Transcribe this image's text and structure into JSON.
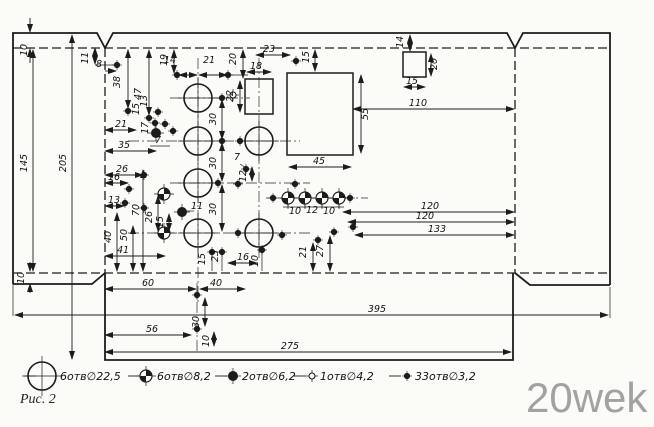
{
  "meta": {
    "caption": "Рис. 2",
    "watermark": "20wek",
    "ink": "#1c1c1c",
    "paper": "#fbfbf8"
  },
  "legend": [
    {
      "type": "d225",
      "symbol": "large-circle-crosshair",
      "sx": 42,
      "lx": 60,
      "label": "6отв∅22,5"
    },
    {
      "type": "d82",
      "symbol": "target-circle",
      "sx": 146,
      "lx": 157,
      "label": "6отв∅8,2"
    },
    {
      "type": "d62",
      "symbol": "filled-circle",
      "sx": 233,
      "lx": 242,
      "label": "2отв∅6,2"
    },
    {
      "type": "d42",
      "symbol": "small-open-circle",
      "sx": 312,
      "lx": 320,
      "label": "1отв∅4,2"
    },
    {
      "type": "d32",
      "symbol": "dot",
      "sx": 407,
      "lx": 415,
      "label": "33отв∅3,2"
    }
  ],
  "holes": {
    "d225": [
      [
        198,
        98
      ],
      [
        198,
        141
      ],
      [
        259,
        141
      ],
      [
        198,
        183
      ],
      [
        198,
        233
      ],
      [
        259,
        233
      ]
    ],
    "d82": [
      [
        164,
        194
      ],
      [
        164,
        233
      ],
      [
        288,
        198
      ],
      [
        305,
        198
      ],
      [
        322,
        198
      ],
      [
        339,
        198
      ]
    ],
    "d62": [
      [
        156,
        133
      ],
      [
        182,
        212
      ]
    ],
    "d42": [
      [
        233,
        95
      ]
    ],
    "d32": [
      [
        117,
        65
      ],
      [
        177,
        75
      ],
      [
        228,
        75
      ],
      [
        296,
        61
      ],
      [
        128,
        111
      ],
      [
        158,
        112
      ],
      [
        149,
        118
      ],
      [
        155,
        123
      ],
      [
        165,
        124
      ],
      [
        173,
        131
      ],
      [
        144,
        175
      ],
      [
        129,
        189
      ],
      [
        125,
        203
      ],
      [
        144,
        208
      ],
      [
        222,
        98
      ],
      [
        222,
        141
      ],
      [
        240,
        141
      ],
      [
        246,
        169
      ],
      [
        218,
        183
      ],
      [
        238,
        184
      ],
      [
        295,
        184
      ],
      [
        238,
        233
      ],
      [
        282,
        235
      ],
      [
        273,
        198
      ],
      [
        350,
        198
      ],
      [
        318,
        240
      ],
      [
        334,
        232
      ],
      [
        353,
        227
      ],
      [
        212,
        252
      ],
      [
        222,
        252
      ],
      [
        262,
        250
      ],
      [
        197,
        295
      ],
      [
        197,
        329
      ]
    ]
  },
  "rect_holes": [
    {
      "x": 245,
      "y": 79,
      "w": 28,
      "h": 35,
      "note": "18x22"
    },
    {
      "x": 287,
      "y": 73,
      "w": 66,
      "h": 82,
      "note": "45x55"
    },
    {
      "x": 403,
      "y": 52,
      "w": 23,
      "h": 25,
      "note": "15x20"
    }
  ],
  "dims": [
    [
      "10",
      27,
      50,
      1
    ],
    [
      "11",
      88,
      58,
      1
    ],
    [
      "8",
      99,
      67,
      0
    ],
    [
      "38",
      120,
      82,
      1
    ],
    [
      "47",
      141,
      94,
      1
    ],
    [
      "19",
      167,
      60,
      1
    ],
    [
      "14",
      170,
      63,
      0
    ],
    [
      "21",
      209,
      63,
      0
    ],
    [
      "13",
      147,
      101,
      1
    ],
    [
      "15",
      139,
      109,
      1
    ],
    [
      "17",
      148,
      128,
      1
    ],
    [
      "7",
      158,
      143,
      0
    ],
    [
      "21",
      121,
      127,
      0
    ],
    [
      "35",
      124,
      148,
      0
    ],
    [
      "26",
      122,
      172,
      0
    ],
    [
      "16",
      114,
      180,
      0
    ],
    [
      "13",
      114,
      203,
      0
    ],
    [
      "40",
      111,
      237,
      1
    ],
    [
      "50",
      127,
      235,
      1
    ],
    [
      "41",
      123,
      253,
      0
    ],
    [
      "70",
      139,
      210,
      1
    ],
    [
      "26",
      152,
      217,
      1
    ],
    [
      "15",
      163,
      222,
      1
    ],
    [
      "11",
      197,
      209,
      0
    ],
    [
      "145",
      27,
      163,
      1
    ],
    [
      "205",
      66,
      163,
      1
    ],
    [
      "20",
      236,
      59,
      1
    ],
    [
      "23",
      269,
      52,
      0
    ],
    [
      "18",
      256,
      69,
      0
    ],
    [
      "22",
      233,
      96,
      1
    ],
    [
      "15",
      309,
      57,
      1
    ],
    [
      "30",
      216,
      119,
      1
    ],
    [
      "30",
      216,
      163,
      1
    ],
    [
      "30",
      216,
      209,
      1
    ],
    [
      "12",
      246,
      176,
      1
    ],
    [
      "7",
      237,
      160,
      0
    ],
    [
      "14",
      403,
      42,
      1
    ],
    [
      "20",
      437,
      64,
      1
    ],
    [
      "15",
      412,
      84,
      0
    ],
    [
      "110",
      418,
      106,
      0
    ],
    [
      "55",
      368,
      114,
      1
    ],
    [
      "45",
      319,
      164,
      0
    ],
    [
      "10",
      295,
      214,
      0
    ],
    [
      "12",
      312,
      213,
      0
    ],
    [
      "10",
      329,
      214,
      0
    ],
    [
      "120",
      430,
      209,
      0
    ],
    [
      "120",
      425,
      219,
      0
    ],
    [
      "133",
      437,
      232,
      0
    ],
    [
      "21",
      306,
      252,
      1
    ],
    [
      "27",
      323,
      251,
      1
    ],
    [
      "15",
      205,
      259,
      1
    ],
    [
      "23",
      218,
      256,
      1
    ],
    [
      "16",
      243,
      260,
      0
    ],
    [
      "10",
      258,
      261,
      1
    ],
    [
      "10",
      24,
      278,
      1
    ],
    [
      "60",
      148,
      286,
      0
    ],
    [
      "40",
      216,
      286,
      0
    ],
    [
      "56",
      152,
      332,
      0
    ],
    [
      "30",
      199,
      322,
      1
    ],
    [
      "10",
      209,
      341,
      1
    ],
    [
      "275",
      290,
      349,
      0
    ],
    [
      "395",
      377,
      312,
      0
    ]
  ]
}
